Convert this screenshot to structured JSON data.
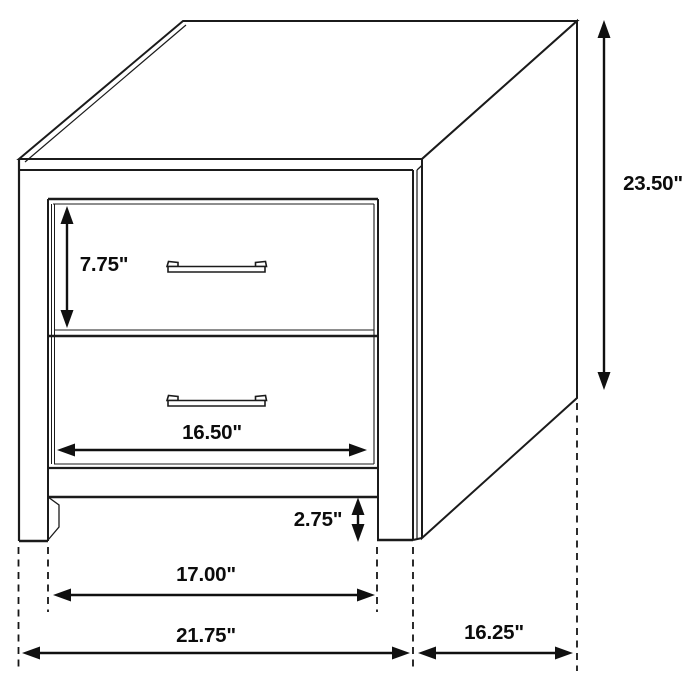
{
  "figure": {
    "object": "two-drawer nightstand",
    "view": "isometric line drawing with dimension arrows",
    "units": "inches"
  },
  "dimensions": {
    "overall_height": "23.50\"",
    "drawer_front_height": "7.75\"",
    "drawer_width": "16.50\"",
    "base_clearance": "2.75\"",
    "inner_leg_span": "17.00\"",
    "overall_width": "21.75\"",
    "depth": "16.25\""
  },
  "colors": {
    "line": "#1b1b1b",
    "dimension": "#101010",
    "background": "#ffffff"
  }
}
